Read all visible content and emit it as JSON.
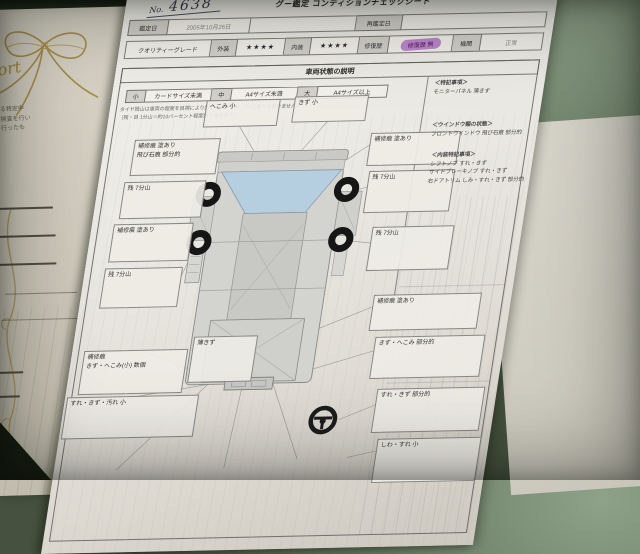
{
  "photo": {
    "corner_caption": "EUVESNC580W"
  },
  "left_paper": {
    "script_text": "port",
    "note_line1": "する特定申",
    "note_line2": "に検査を行い",
    "note_line3": "を行ったも"
  },
  "sheet": {
    "no_label": "No.",
    "no_value": "4638",
    "title": "グー鑑定 コンディションチェックシート",
    "header": {
      "appraisal_date_label": "鑑定日",
      "appraisal_date_value": "2005年10月26日",
      "reappraisal_date_label": "再鑑定日",
      "quality_grade_label": "クオリティーグレード",
      "exterior_label": "外装",
      "exterior_stars": "★★★★",
      "interior_label": "内装",
      "interior_stars": "★★★★",
      "repair_history_label": "修復歴",
      "repair_history_stamp": "修復歴 無",
      "engine_label": "機関",
      "engine_value": "正常"
    },
    "section_title": "車両状態の説明",
    "size_legend": [
      {
        "code": "小",
        "desc": "カードサイズ未満"
      },
      {
        "code": "中",
        "desc": "A4サイズ未満"
      },
      {
        "code": "大",
        "desc": "A4サイズ以上"
      }
    ],
    "disclaimer_line1": "タイヤ残山は車両の程度を目視により判定しています。（※正確ではありません）",
    "disclaimer_line2": "〔残・目 1分山＝約10パーセント程度残り溝を表す〕",
    "diagram_labels": {
      "front_left": "へこみ 小",
      "front_right": "きず 小",
      "left_1a": "補修痕 塗あり",
      "left_1b": "飛び石痕 部分的",
      "left_2": "残 7分山",
      "left_3": "補修痕 塗あり",
      "left_4": "残 7分山",
      "right_1": "補修痕 塗あり",
      "right_2": "残 7分山",
      "right_3": "残 7分山",
      "right_4": "補修痕 塗あり",
      "right_5": "きず・へこみ 部分的",
      "right_6": "すれ・きず 部分的",
      "right_7": "しわ・すれ 小",
      "rear_center": "薄きず",
      "rear_left_a": "補修痕",
      "rear_left_b": "きず・へこみ(小) 数個",
      "bottom_left": "すれ・きず・汚れ 小"
    },
    "notes": [
      {
        "heading": "＜特記事項＞",
        "line1": "モニターパネル 薄きず",
        "line2": "",
        "line3": ""
      },
      {
        "heading": "＜ウインドウ類の状態＞",
        "line1": "フロントウインドウ 飛び石痕 部分的",
        "line2": "",
        "line3": ""
      },
      {
        "heading": "＜内装特記事項＞",
        "line1": "シフトノブ すれ・きず",
        "line2": "サイドブレーキノブ すれ・きず",
        "line3": "右ドアトリム しみ・すれ・きず 部分的"
      }
    ],
    "colors": {
      "stamp_purple": "#b06ec4",
      "windshield_blue": "#b4cee1",
      "table_green": "#64775f"
    }
  }
}
